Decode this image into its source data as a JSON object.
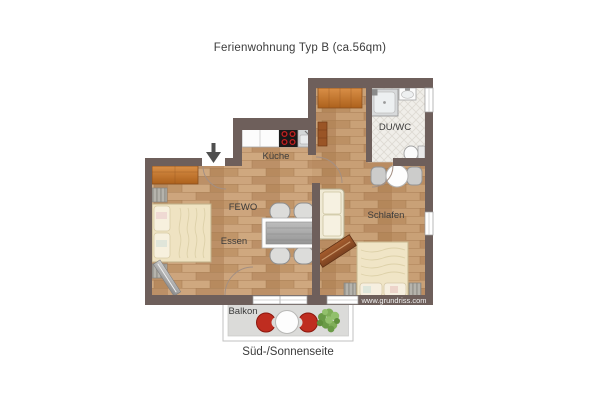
{
  "title": "Ferienwohnung Typ B (ca.56qm)",
  "labels": {
    "kueche": "Küche",
    "fewo": "FEWO",
    "essen": "Essen",
    "schlafen": "Schlafen",
    "du_wc": "DU/WC",
    "balkon": "Balkon",
    "orientation": "Süd-/Sonnenseite",
    "watermark": "www.grundriss.com"
  },
  "icons": {
    "entry_arrow": "down-arrow marking the apartment entrance"
  },
  "colors": {
    "wall": "#6e5f5b",
    "wood_floor": "#c49a72",
    "tile_floor": "#f0eee9",
    "balcony_floor": "#dbdbd9",
    "furniture_orange": "#c87d36",
    "bed_cream": "#efe3c2",
    "balcony_chair_red": "#bf2d20",
    "plant_green": "#7fae58",
    "stove_burner_red": "#c32222",
    "label_text": "#3b3b3b"
  }
}
